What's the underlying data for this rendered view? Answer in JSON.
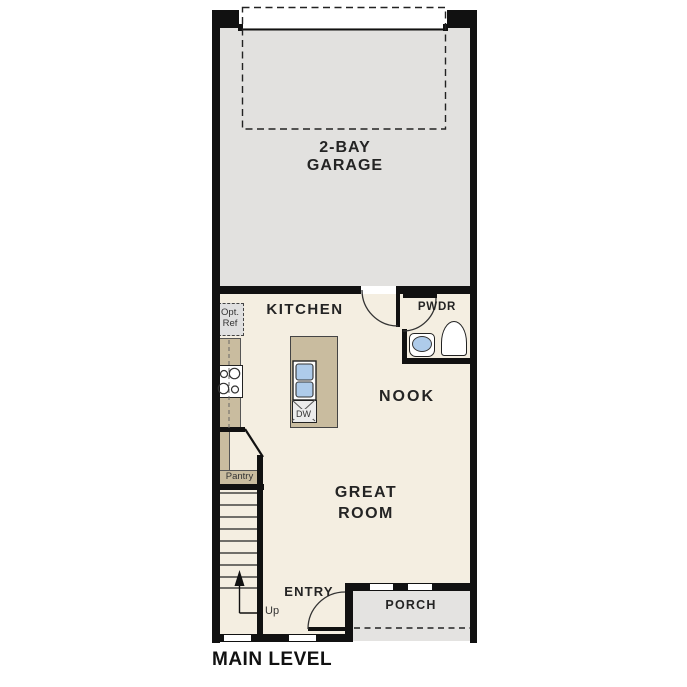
{
  "plan": {
    "title": "MAIN LEVEL",
    "rooms": {
      "garage": "2-BAY\nGARAGE",
      "kitchen": "KITCHEN",
      "powder": "PWDR",
      "nook": "NOOK",
      "great_room": "GREAT\nROOM",
      "entry": "ENTRY",
      "porch": "PORCH",
      "pantry": "Pantry"
    },
    "annotations": {
      "optional_refrigerator": "Opt.\nRef",
      "dishwasher": "DW",
      "stairs_direction": "Up"
    },
    "colors": {
      "wall": "#111111",
      "interior_floor": "#f4eee1",
      "garage_floor": "#e2e1df",
      "porch_floor": "#e4e3e1",
      "counter_tan": "#c9bc9f",
      "fixture_blue": "#aecbea",
      "appliance_gray": "#ececec"
    }
  }
}
